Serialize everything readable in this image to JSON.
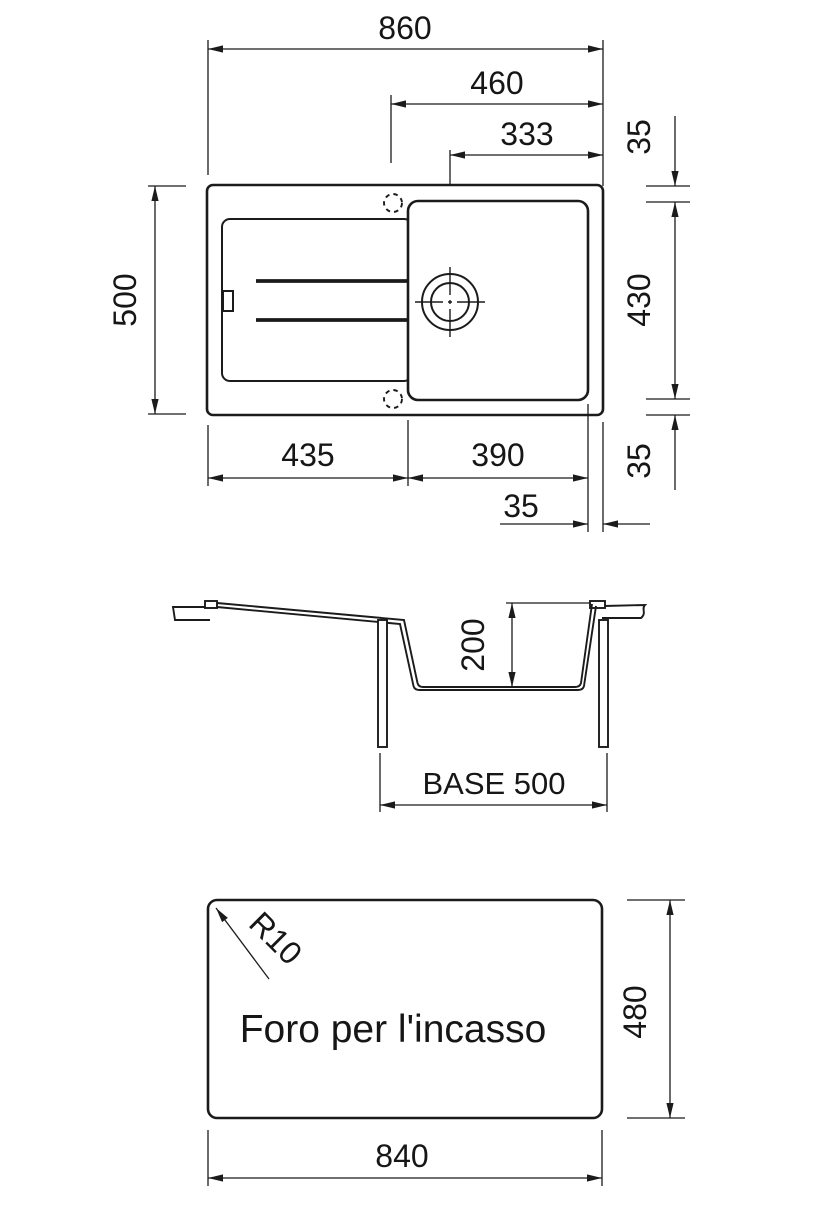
{
  "drawing": {
    "type": "sink-technical-drawing",
    "line_color": "#1b1b1b",
    "background_color": "#ffffff"
  },
  "top_view": {
    "dim_860": "860",
    "dim_460": "460",
    "dim_333": "333",
    "dim_35_top_right": "35",
    "dim_500": "500",
    "dim_430": "430",
    "dim_35_bottom_right": "35",
    "dim_435": "435",
    "dim_390": "390",
    "dim_35_offset": "35"
  },
  "section_view": {
    "dim_200": "200",
    "base_label": "BASE 500"
  },
  "bottom_view": {
    "radius_label": "R10",
    "cutout_label": "Foro per l'incasso",
    "dim_480": "480",
    "dim_840": "840"
  }
}
